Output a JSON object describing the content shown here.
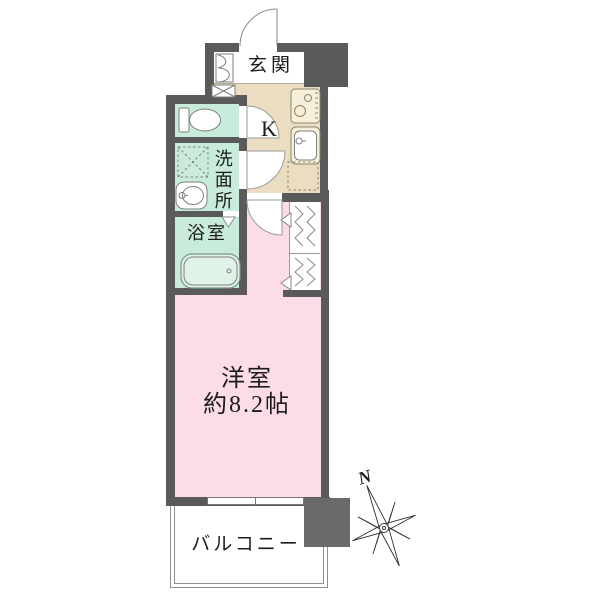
{
  "title": "apartment-floor-plan",
  "colors": {
    "wall": "#5a5a5a",
    "pillar": "#6a6a6a",
    "room_pink": "#fbdce7",
    "wet_mint": "#c8ebdb",
    "kitchen_beige": "#eaddc1",
    "text": "#1c1c1c",
    "fixture_line": "#7f7f7f"
  },
  "rooms": {
    "entrance": {
      "label": "玄関"
    },
    "kitchen": {
      "label": "K"
    },
    "washroom": {
      "label": "洗面所"
    },
    "bathroom": {
      "label": "浴室"
    },
    "main_room": {
      "name": "洋室",
      "size": "約8.2帖"
    },
    "balcony": {
      "label": "バルコニー"
    }
  },
  "compass": {
    "north_label": "N"
  },
  "icons": {
    "entrance_door": "swing-door-arc",
    "room_door": "swing-door-arc",
    "toilet_door": "swing-door-arc",
    "washroom_door": "swing-door-arc",
    "bathroom_door": "triangle-door-marker",
    "toilet": "toilet-bowl-with-tank",
    "washer_space": "dashed-x-box",
    "vanity_sink": "oval-basin-with-tap",
    "bathtub": "rounded-bathtub",
    "stove": "two-burner-stove",
    "kitchen_sink": "sink-basin-with-tap",
    "refrigerator_space": "dotted-box",
    "shoe_cabinet": "double-leaf-cabinet",
    "closet": "hanger-zigzag",
    "shoe_box": "x-box",
    "window": "sliding-window",
    "compass_rose": "eight-point-star"
  }
}
